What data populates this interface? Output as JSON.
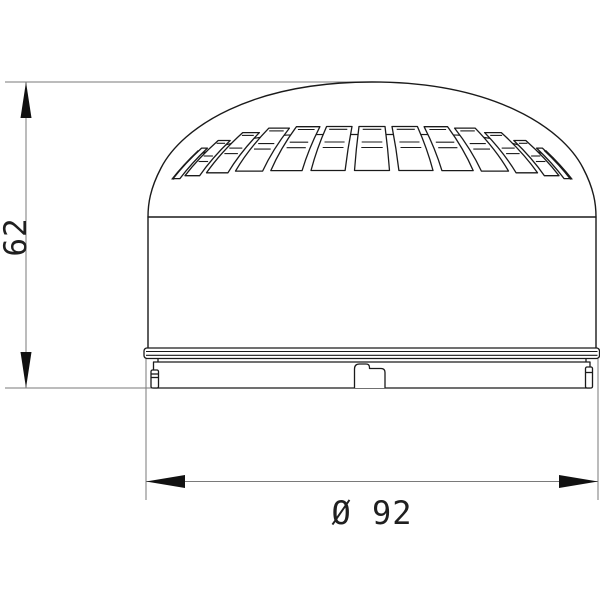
{
  "drawing": {
    "type": "technical-dimension-drawing",
    "subject": "dome sounder / beacon, front elevation",
    "colors": {
      "object_line": "#1a1a1a",
      "dimension_line": "#7a7a7a",
      "arrow_fill": "#111111",
      "background": "#ffffff"
    },
    "dimensions": {
      "height": {
        "label": "62",
        "value": 62
      },
      "diameter": {
        "label": "Ø 92",
        "value": 92,
        "symbol": "Ø"
      }
    },
    "geometry": {
      "dome": {
        "cx": 372,
        "cy": 337,
        "r": 255
      },
      "slots": {
        "count_each_side": 7,
        "pitch_deg": 13.2,
        "half_width_deg": 5.2,
        "top_y": 126.5,
        "bottom_y": 170.5,
        "droop_top": 24,
        "droop_bottom": 9,
        "cap_offset": 2.8,
        "rib_offsets": [
          15.5,
          21
        ],
        "rib_inset_deg": 1.6,
        "band_y": 134.5,
        "detail_max_k": 5
      }
    }
  }
}
